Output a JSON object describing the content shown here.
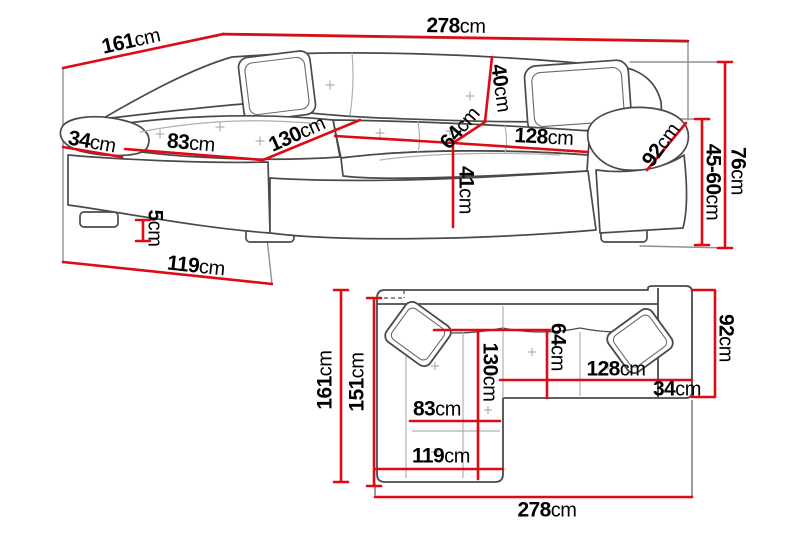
{
  "diagram_title": "corner-sofa-dimension-diagram",
  "unit": "cm",
  "colors": {
    "dimension_line": "#df0a14",
    "sofa_outline": "#4a4a4a",
    "frame_line": "#909090",
    "seam_line": "#b0b0b0",
    "background": "#ffffff",
    "text": "#000000"
  },
  "views": {
    "perspective": "perspective-view-sofa",
    "plan": "top-down-view-sofa"
  },
  "dims": {
    "t_width": {
      "value": "278",
      "unit": "cm"
    },
    "t_depth": {
      "value": "161",
      "unit": "cm"
    },
    "t_back": {
      "value": "40",
      "unit": "cm"
    },
    "t_seatdepth": {
      "value": "64",
      "unit": "cm"
    },
    "t_seatwidth": {
      "value": "128",
      "unit": "cm"
    },
    "t_armdiag": {
      "value": "92",
      "unit": "cm"
    },
    "t_height": {
      "value": "76",
      "unit": "cm"
    },
    "t_heightrange": {
      "value": "45-60",
      "unit": "cm"
    },
    "t_armwidth": {
      "value": "34",
      "unit": "cm"
    },
    "t_chaisewidth": {
      "value": "83",
      "unit": "cm"
    },
    "t_chaiselen": {
      "value": "130",
      "unit": "cm"
    },
    "t_seatheight": {
      "value": "41",
      "unit": "cm"
    },
    "t_leg": {
      "value": "5",
      "unit": "cm"
    },
    "t_chaisefront": {
      "value": "119",
      "unit": "cm"
    },
    "b_depth": {
      "value": "161",
      "unit": "cm"
    },
    "b_inner": {
      "value": "151",
      "unit": "cm"
    },
    "b_chaiselen": {
      "value": "130",
      "unit": "cm"
    },
    "b_seatdepth": {
      "value": "64",
      "unit": "cm"
    },
    "b_seatwidth": {
      "value": "128",
      "unit": "cm"
    },
    "b_armwidth": {
      "value": "34",
      "unit": "cm"
    },
    "b_armdepth": {
      "value": "92",
      "unit": "cm"
    },
    "b_chaisewidth": {
      "value": "83",
      "unit": "cm"
    },
    "b_chaisefront": {
      "value": "119",
      "unit": "cm"
    },
    "b_width": {
      "value": "278",
      "unit": "cm"
    }
  }
}
